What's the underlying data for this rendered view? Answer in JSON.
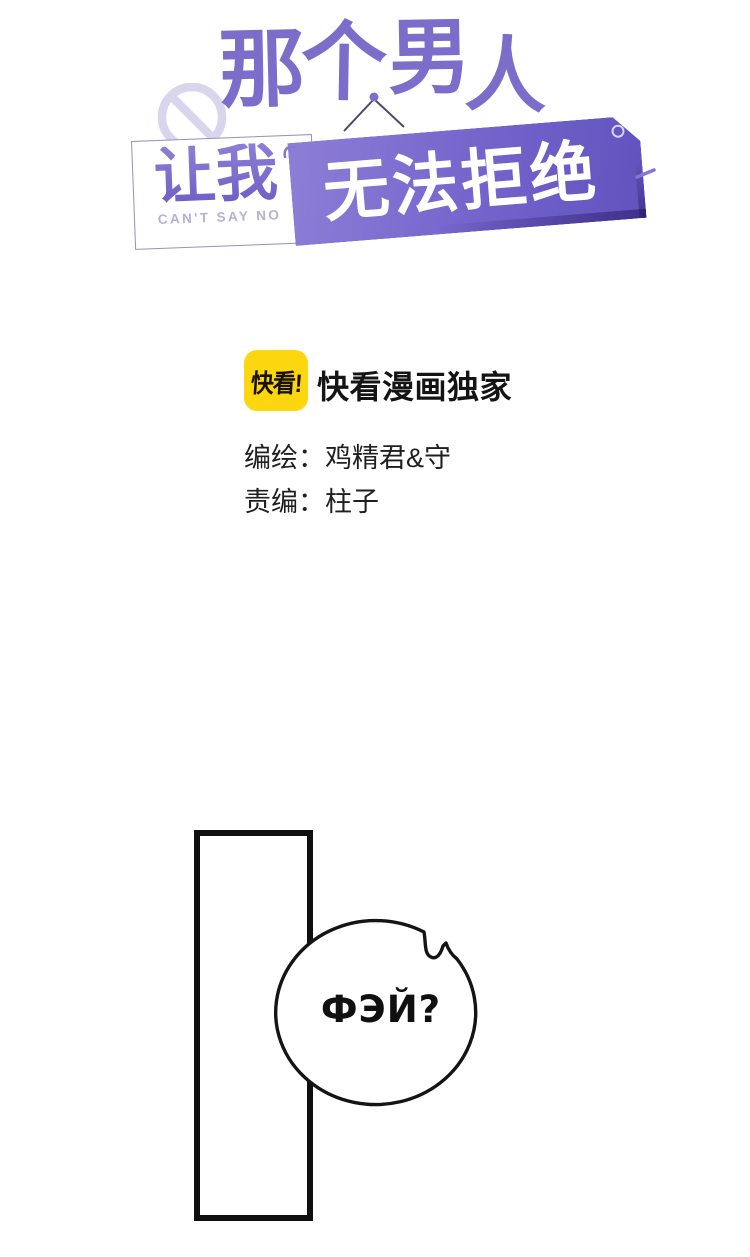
{
  "page": {
    "background": "#ffffff"
  },
  "title_logo": {
    "main_title": {
      "text": "那个男人",
      "chars": [
        "那",
        "个",
        "男",
        "人"
      ],
      "color": "#7b6dc9"
    },
    "subtitle_card": {
      "text": "让我",
      "caption": "CAN'T SAY NO",
      "text_color": "#7e6ecb",
      "caption_color": "#b6b0d6"
    },
    "hanging_sign": {
      "text": "无法拒绝",
      "text_color": "#ffffff",
      "bg_color": "#6f5ec7"
    },
    "no_entry_color": "#d9d5ec"
  },
  "publisher": {
    "badge_text": "快看!",
    "badge_color": "#fcd70f",
    "exclusive_label": "快看漫画独家"
  },
  "credits": {
    "artist_line": "编绘：鸡精君&守",
    "editor_line": "责编：柱子"
  },
  "comic": {
    "speech_bubble": {
      "text": "ФЭЙ?"
    }
  }
}
